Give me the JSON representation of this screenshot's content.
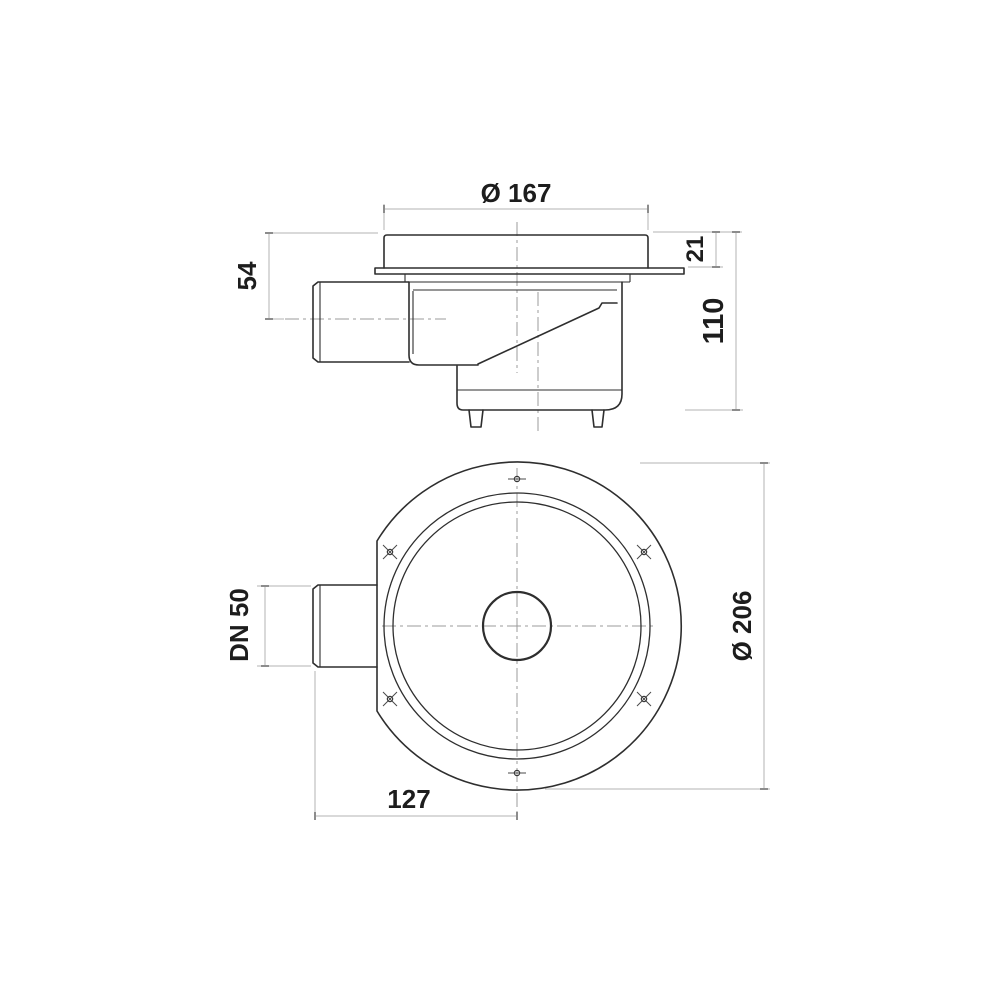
{
  "page": {
    "background": "#ffffff"
  },
  "drawing": {
    "type": "technical-drawing",
    "subject": "floor drain with side outlet, two orthographic views",
    "views": {
      "side_view": {
        "name": "side elevation",
        "dimensions": [
          {
            "id": "dia167",
            "label": "Ø 167",
            "meaning": "top grate diameter"
          },
          {
            "id": "h21",
            "label": "21",
            "meaning": "height of top section above flange"
          },
          {
            "id": "h54",
            "label": "54",
            "meaning": "top surface to outlet pipe centerline"
          },
          {
            "id": "h110",
            "label": "110",
            "meaning": "overall body height"
          }
        ]
      },
      "plan_view": {
        "name": "top plan",
        "dimensions": [
          {
            "id": "dn50",
            "label": "DN 50",
            "meaning": "outlet pipe nominal diameter"
          },
          {
            "id": "dia206",
            "label": "Ø 206",
            "meaning": "outer flange diameter"
          },
          {
            "id": "w127",
            "label": "127",
            "meaning": "pipe end to body center"
          }
        ],
        "bolt_hole_count": 6
      }
    },
    "colors": {
      "object_line": "#2e2e2e",
      "dimension_line": "#b3b3b3",
      "tick": "#8c8c8c",
      "centerline": "#9b9b9b",
      "text": "#1d1d1d",
      "background": "#ffffff"
    }
  }
}
